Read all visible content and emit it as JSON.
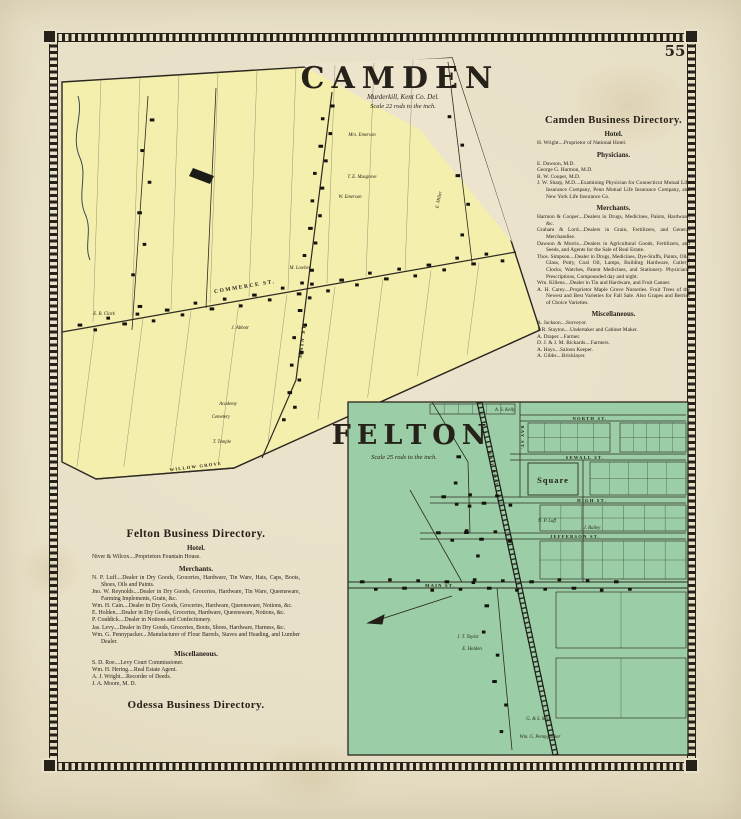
{
  "page": {
    "number": "55"
  },
  "camden": {
    "map": {
      "title": "CAMDEN",
      "region": "Murderkill, Kent Co. Del.",
      "scale": "Scale 22 rods to the inch.",
      "streets": {
        "commerce": "COMMERCE ST.",
        "main": "MAIN ST.",
        "willow_grove": "WILLOW GROVE"
      },
      "labels": [
        "Mrs. Emerson",
        "T. E. Musgrove",
        "W. Emerson",
        "M. Lowber",
        "E. Miller",
        "E. B. Clark",
        "J. Abbott",
        "Academy",
        "Cemetery",
        "T. Temple"
      ]
    },
    "directory": {
      "title": "Camden Business Directory.",
      "sections": [
        {
          "heading": "Hotel.",
          "entries": [
            "H. Wright....Proprietor of National Hotel."
          ]
        },
        {
          "heading": "Physicians.",
          "entries": [
            "E. Dawson, M.D.",
            "George G. Harmon, M.D.",
            "R. W. Cooper, M.D.",
            "J. W. Sharp, M.D....Examining Physician for Connecticut Mutual Life Insurance Company, Penn Mutual Life Insurance Company, and New York Life Insurance Co."
          ]
        },
        {
          "heading": "Merchants.",
          "entries": [
            "Harmon & Cooper....Dealers in Drugs, Medicines, Paints, Hardware, &c.",
            "Graham & Lord....Dealers in Grain, Fertilizers, and General Merchandise.",
            "Dawson & Morris....Dealers in Agricultural Goods, Fertilizers, and Seeds, and Agents for the Sale of Real Estate.",
            "Thos. Simpson....Dealer in Drugs, Medicines, Dye-Stuffs, Paints, Oils, Glass, Putty, Coal Oil, Lamps, Building Hardware, Cutlery, Clocks, Watches, Patent Medicines, and Stationery. Physicians' Prescriptions, Compounded day and night.",
            "Wm. Killens....Dealer in Tin and Hardware, and Fruit Canner.",
            "A. H. Carey....Proprietor Maple Grove Nurseries. Fruit Trees of the Newest and Best Varieties for Fall Sale. Also Grapes and Berries of Choice Varieties."
          ]
        },
        {
          "heading": "Miscellaneous.",
          "entries": [
            "A. Jackson....Surveyor.",
            "J. R. Stayton....Undertaker and Cabinet Maker.",
            "A. Draper....Farmer.",
            "D. J. & J. M. Rickards....Farmers.",
            "A. Hays....Saloon Keeper.",
            "A. Gibbs....Bricklayer."
          ]
        }
      ]
    }
  },
  "felton": {
    "map": {
      "title": "FELTON",
      "scale": "Scale 25 rods to the inch.",
      "streets": {
        "north": "NORTH ST.",
        "sewall": "SEWALL ST.",
        "high": "HIGH ST.",
        "jefferson": "JEFFERSON ST.",
        "main": "MAIN ST.",
        "bay": "BAY ST.",
        "railroad": "RAIL ROAD"
      },
      "labels": [
        "A. S. Kelly",
        "N. P. Luff",
        "J. Bailey",
        "Square",
        "E. Holden",
        "J. T. Taylor",
        "G. & S. Mill",
        "Wm. G. Pennypacker"
      ]
    },
    "directory": {
      "title": "Felton Business Directory.",
      "sections": [
        {
          "heading": "Hotel.",
          "entries": [
            "Niver & Wilcox....Proprietors Fountain House."
          ]
        },
        {
          "heading": "Merchants.",
          "entries": [
            "N. P. Luff....Dealer in Dry Goods, Groceries, Hardware, Tin Ware, Hats, Caps, Boots, Shoes, Oils and Paints.",
            "Jno. W. Reynolds....Dealer in Dry Goods, Groceries, Hardware, Tin Ware, Queensware, Farming Implements, Grain, &c.",
            "Wm. H. Cain....Dealer in Dry Goods, Groceries, Hardware, Queensware, Notions, &c.",
            "E. Holden....Dealer in Dry Goods, Groceries, Hardware, Queensware, Notions, &c.",
            "P. Craddick....Dealer in Notions and Confectionery.",
            "Jas. Levy....Dealer in Dry Goods, Groceries, Boots, Shoes, Hardware, Harness, &c.",
            "Wm. G. Pennypacker....Manufacturer of Flour Barrels, Staves and Heading, and Lumber Dealer."
          ]
        },
        {
          "heading": "Miscellaneous.",
          "entries": [
            "S. D. Roe....Levy Court Commissioner.",
            "Wm. H. Hering....Real Estate Agent.",
            "A. J. Wright....Recorder of Deeds.",
            "J. A. Moore, M. D."
          ]
        }
      ]
    }
  },
  "odessa": {
    "directory_title": "Odessa Business Directory."
  }
}
